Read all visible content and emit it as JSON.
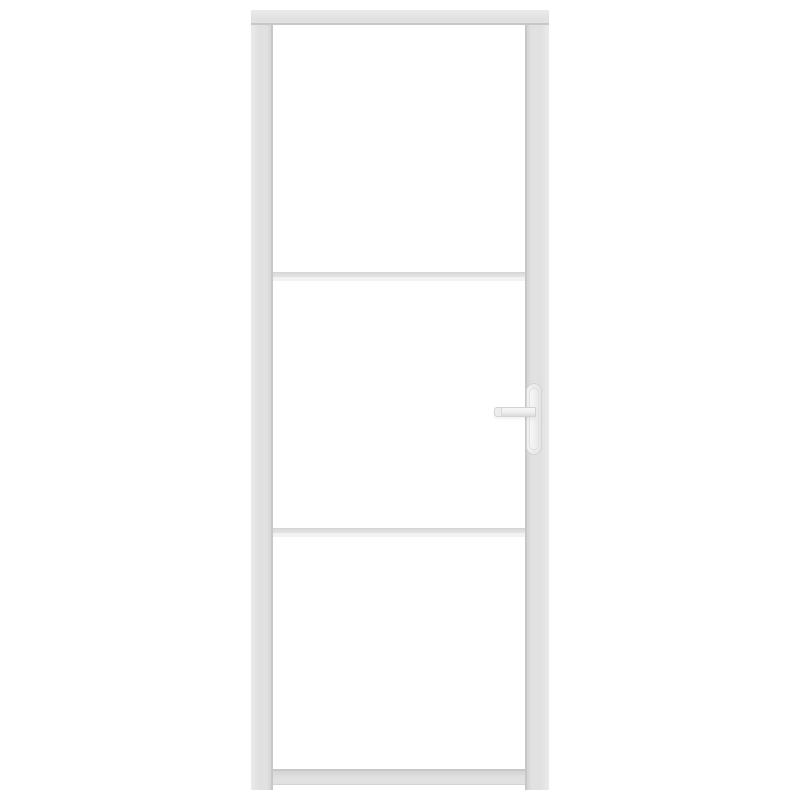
{
  "scene": {
    "description": "Product photo of a white interior door with three white frosted glass panels separated by two horizontal glazing bars, framed in white-painted metal, with a lever door handle mounted on a vertical backplate on the right stile, centered on a plain white background",
    "object": "interior glass door",
    "orientation": "front view, vertical",
    "text_content": "none"
  },
  "door": {
    "panel_count": 3,
    "muntin_count": 2,
    "handle_side": "right",
    "handle_type": "lever on backplate",
    "frame_style": "slim industrial-style frame"
  },
  "colors": {
    "background": "#ffffff",
    "glass": "#ffffff",
    "frame": "#e1e1e1",
    "frame_light": "#ebebeb",
    "frame_dark": "#d4d4d4",
    "frame_edge": "#c7c7c7",
    "muntin_shadow": "#f2f2f2",
    "handle": "#f1f1f1",
    "handle_edge": "#d3d3d3"
  }
}
